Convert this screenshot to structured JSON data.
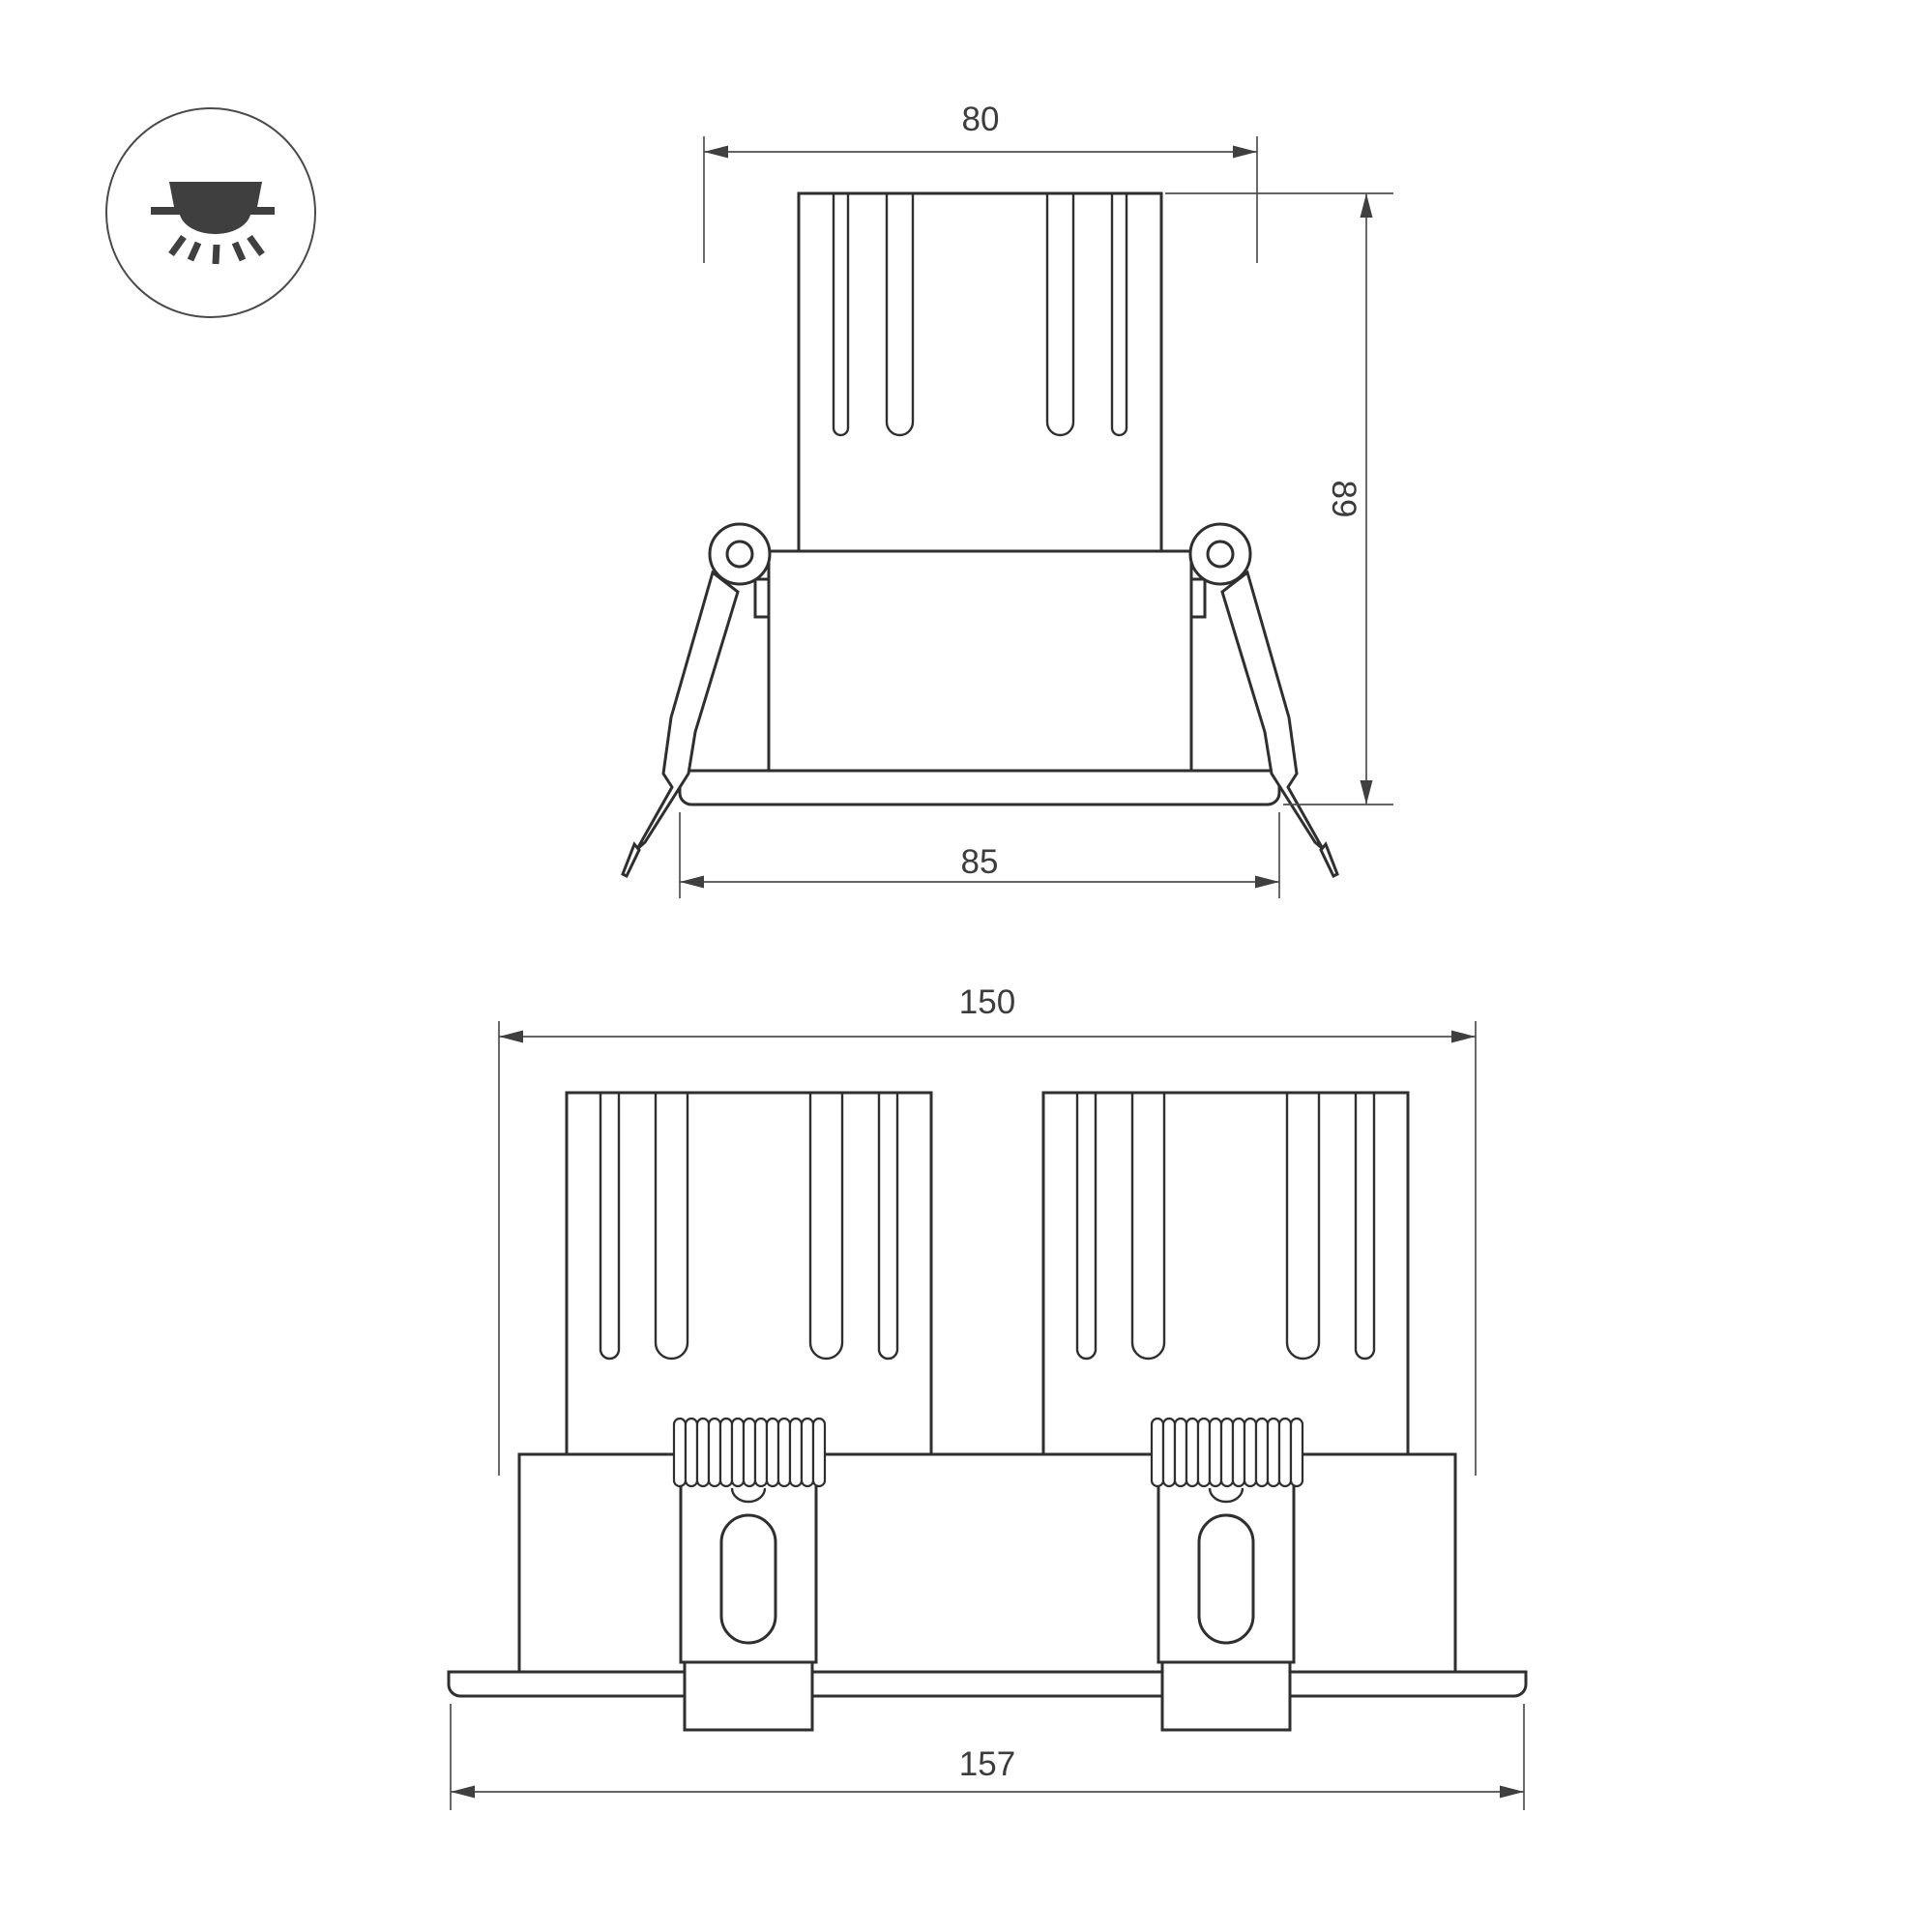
{
  "drawing": {
    "background": "#ffffff",
    "badge": {
      "icon": "recessed-downlight-icon"
    },
    "views": {
      "single": {
        "name": "single downlight front view",
        "dims": {
          "width_top": "80",
          "height": "89",
          "width_flange": "85"
        }
      },
      "double": {
        "name": "twin downlight front view",
        "dims": {
          "width_top": "150",
          "width_flange": "157"
        }
      }
    },
    "colors": {
      "outline": "#2f2f2f",
      "dimension_lines": "#4f4f4f",
      "label_text": "#3c3c3c",
      "icon_fill": "#3f3f3f"
    }
  }
}
